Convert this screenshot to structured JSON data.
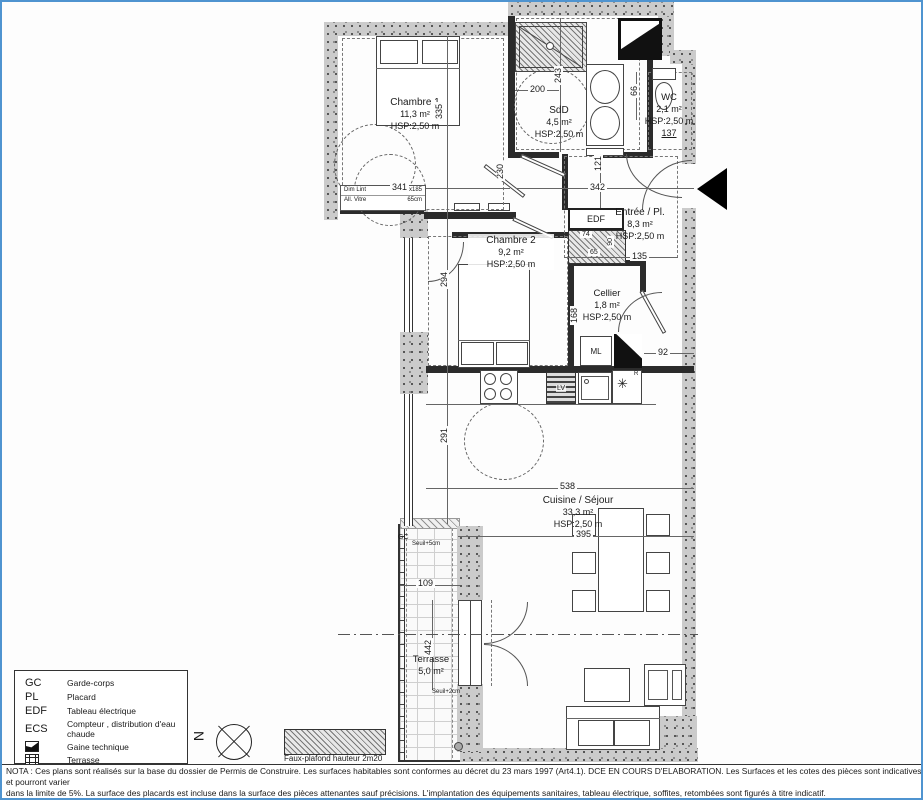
{
  "rooms": {
    "chambre1": {
      "name": "Chambre 1",
      "area": "11,3 m²",
      "hsp": "HSP:2,50 m"
    },
    "sdd": {
      "name": "SdD",
      "area": "4,5 m²",
      "hsp": "HSP:2,50 m"
    },
    "wc": {
      "name": "WC",
      "area": "2,1 m²",
      "hsp": "HSP:2,50 m"
    },
    "entree": {
      "name": "Entrée / Pl.",
      "area": "8,3 m²",
      "hsp": "HSP:2,50 m"
    },
    "chambre2": {
      "name": "Chambre 2",
      "area": "9,2 m²",
      "hsp": "HSP:2,50 m"
    },
    "cellier": {
      "name": "Cellier",
      "area": "1,8 m²",
      "hsp": "HSP:2,50 m"
    },
    "cuisine": {
      "name": "Cuisine / Séjour",
      "area": "33,3 m²",
      "hsp": "HSP:2,50 m"
    },
    "terrasse": {
      "name": "Terrasse",
      "area": "5,0 m²"
    }
  },
  "dims": {
    "d341": "341",
    "d342": "342",
    "d335": "335",
    "d243": "243",
    "d200": "200",
    "d137": "137",
    "d121": "121",
    "d66": "66",
    "d230": "230",
    "d294": "294",
    "d291": "291",
    "d135": "135",
    "d74": "74",
    "d65": "65",
    "d90": "90",
    "d92": "92",
    "d168": "168",
    "d538": "538",
    "d395": "395",
    "d109": "109",
    "d442": "442"
  },
  "labels": {
    "edf": "EDF",
    "ml": "ML",
    "lv": "LV",
    "fridge_r": "R",
    "snowflake": "✳",
    "gc": "GC",
    "seuil5": "Seuil+5cm",
    "seuil2": "Seuil+2cm",
    "north": "N",
    "faux_plafond": "Faux-plafond hauteur 2m20",
    "win_row1a": "Dim Lint",
    "win_row1b": "90x185",
    "win_row2a": "All. Vitre",
    "win_row2b": "65cm"
  },
  "legend": {
    "rows": [
      {
        "abbr": "GC",
        "label": "Garde-corps"
      },
      {
        "abbr": "PL",
        "label": "Placard"
      },
      {
        "abbr": "EDF",
        "label": "Tableau électrique"
      },
      {
        "abbr": "ECS",
        "label": "Compteur , distribution d'eau chaude"
      },
      {
        "abbr": "",
        "label": "Gaine technique"
      },
      {
        "abbr": "",
        "label": "Terrasse"
      }
    ]
  },
  "nota": {
    "line1": "NOTA : Ces plans sont réalisés sur la base du dossier de Permis de Construire. Les surfaces habitables sont conformes au décret du 23 mars 1997 (Art4.1). DCE EN COURS D'ELABORATION. Les Surfaces et les cotes des pièces sont indicatives et pourront varier",
    "line2": "dans la limite de 5%. La surface des placards est incluse dans la surface des pièces attenantes sauf précisions. L'implantation des équipements sanitaires, tableau électrique, soffites, retombées sont figurés à titre indicatif.",
    "line3": "Tout en conservant les caractéristiques essentielles du plan, des modifications sont susceptibles d'être apportées en fonction des nécessités techniques et réglementaires lors de la réalisation."
  }
}
